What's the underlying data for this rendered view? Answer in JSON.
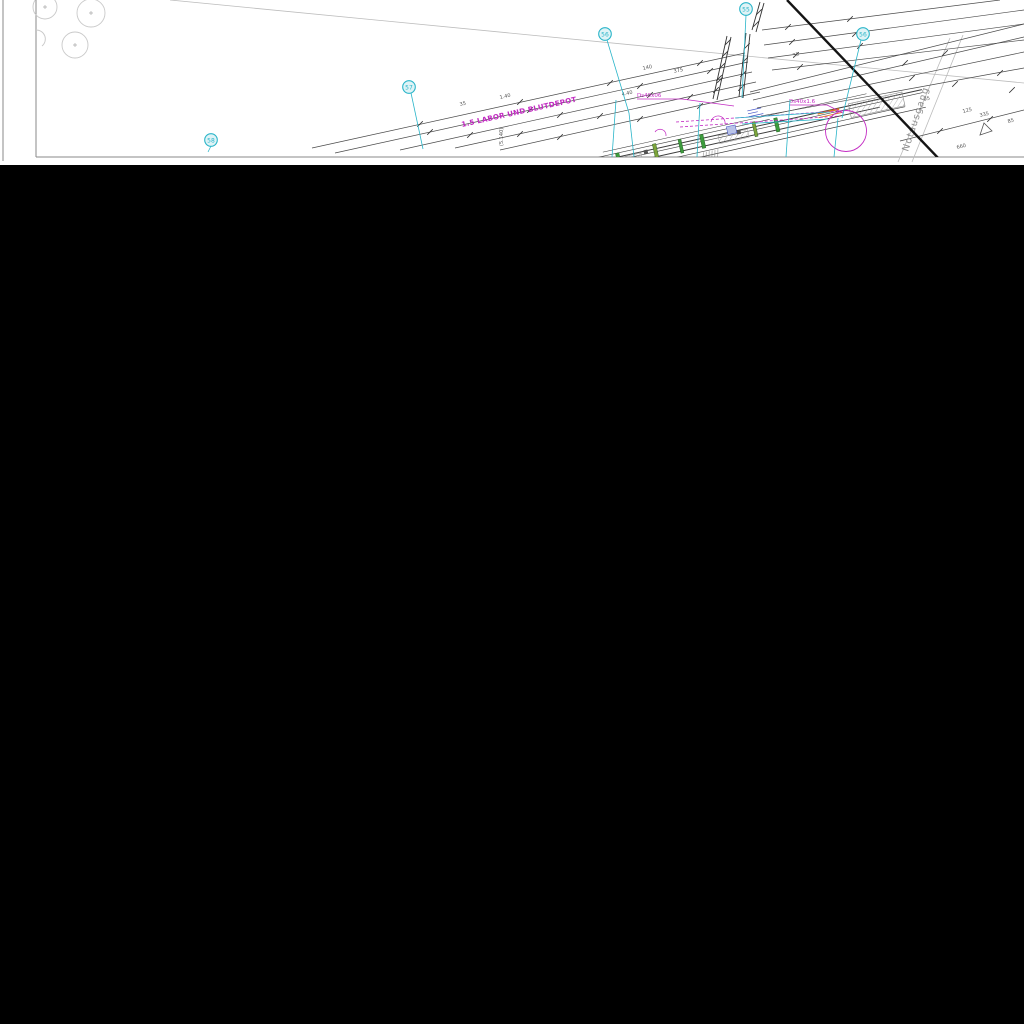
{
  "sheet": {
    "type": "architectural-floor-plan-sheet",
    "bubbles": [
      {
        "label": "58"
      },
      {
        "label": "57"
      },
      {
        "label": "56"
      },
      {
        "label": "55"
      },
      {
        "label": "56"
      }
    ],
    "labels": {
      "room": "1.5 LABOR UND BLUTDEPOT",
      "duct_small": "Ds40x06",
      "duct_large": "Ds40x1.6",
      "exit": "Notausgang"
    },
    "dimensions": [
      "35",
      "1.40",
      "140",
      "375",
      "4.40",
      "(5.140)",
      "95",
      "125",
      "335",
      "85",
      "660"
    ],
    "colors": {
      "bubble_cyan": "#2ab5c9",
      "annotation_magenta": "#c32bc3",
      "column_green": "#3d9b3d",
      "column_olive": "#7da23b",
      "door_orange": "#e2791f",
      "note_blue": "#4253c5",
      "line_dark": "#3c3c3c",
      "tree_gray": "#c9c9c9",
      "sheet_white": "#ffffff",
      "background_black": "#000000"
    }
  }
}
